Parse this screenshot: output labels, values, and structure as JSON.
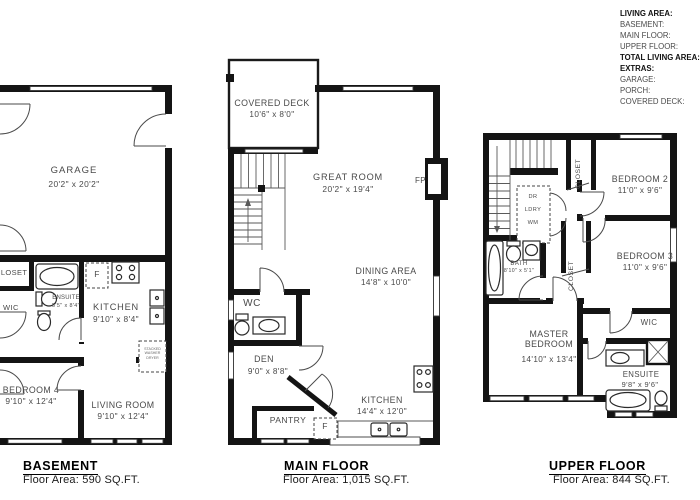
{
  "legend": {
    "living_area_label": "LIVING AREA:",
    "basement_label": "BASEMENT:",
    "main_floor_label": "MAIN FLOOR:",
    "upper_floor_label": "UPPER FLOOR:",
    "total_label": "TOTAL LIVING AREA:",
    "extras_label": "EXTRAS:",
    "garage_label": "GARAGE:",
    "porch_label": "PORCH:",
    "covered_deck_label": "COVERED DECK:"
  },
  "basement": {
    "title": "BASEMENT",
    "floor_area": "Floor Area: 590 SQ.FT.",
    "garage_name": "GARAGE",
    "garage_dims": "20'2\" x 20'2\"",
    "closet_name": "CLOSET",
    "ensuite_name": "ENSUITE",
    "ensuite_dims": "5'5\" x 8'4\"",
    "wic_name": "WIC",
    "kitchen_name": "KITCHEN",
    "kitchen_dims": "9'10\" x 8'4\"",
    "bedroom4_name": "BEDROOM 4",
    "bedroom4_dims": "9'10\" x 12'4\"",
    "living_name": "LIVING ROOM",
    "living_dims": "9'10\" x 12'4\"",
    "fridge_label": "F",
    "washer_dryer_label": "STACKED WASHER DRYER"
  },
  "main": {
    "title": "MAIN FLOOR",
    "floor_area": "Floor Area: 1,015 SQ.FT.",
    "deck_name": "COVERED DECK",
    "deck_dims": "10'6\" x 8'0\"",
    "great_name": "GREAT ROOM",
    "great_dims": "20'2\" x 19'4\"",
    "fireplace_label": "FP",
    "dining_name": "DINING AREA",
    "dining_dims": "14'8\" x 10'0\"",
    "wc_name": "WC",
    "den_name": "DEN",
    "den_dims": "9'0\" x 8'8\"",
    "pantry_name": "PANTRY",
    "kitchen_name": "KITCHEN",
    "kitchen_dims": "14'4\" x 12'0\"",
    "fridge_label": "F"
  },
  "upper": {
    "title": "UPPER FLOOR",
    "floor_area": "Floor Area: 844 SQ.FT.",
    "closet_bed2_name": "CLOSET",
    "bedroom2_name": "BEDROOM 2",
    "bedroom2_dims": "11'0\" x 9'6\"",
    "closet_bed3_name": "CLOSET",
    "bedroom3_name": "BEDROOM 3",
    "bedroom3_dims": "11'0\" x 9'6\"",
    "dryer_label": "DR",
    "laundry_label": "LDRY",
    "washer_label": "WM",
    "bath_name": "BATH",
    "bath_dims": "8'10\" x 5'1\"",
    "master_name": "MASTER BEDROOM",
    "master_dims": "14'10\" x 13'4\"",
    "wic_name": "WIC",
    "ensuite_name": "ENSUITE",
    "ensuite_dims": "9'8\" x 9'6\""
  },
  "colors": {
    "wall": "#141414",
    "text": "#4a4a4a",
    "title": "#000000",
    "line": "#333333",
    "background": "#ffffff"
  }
}
